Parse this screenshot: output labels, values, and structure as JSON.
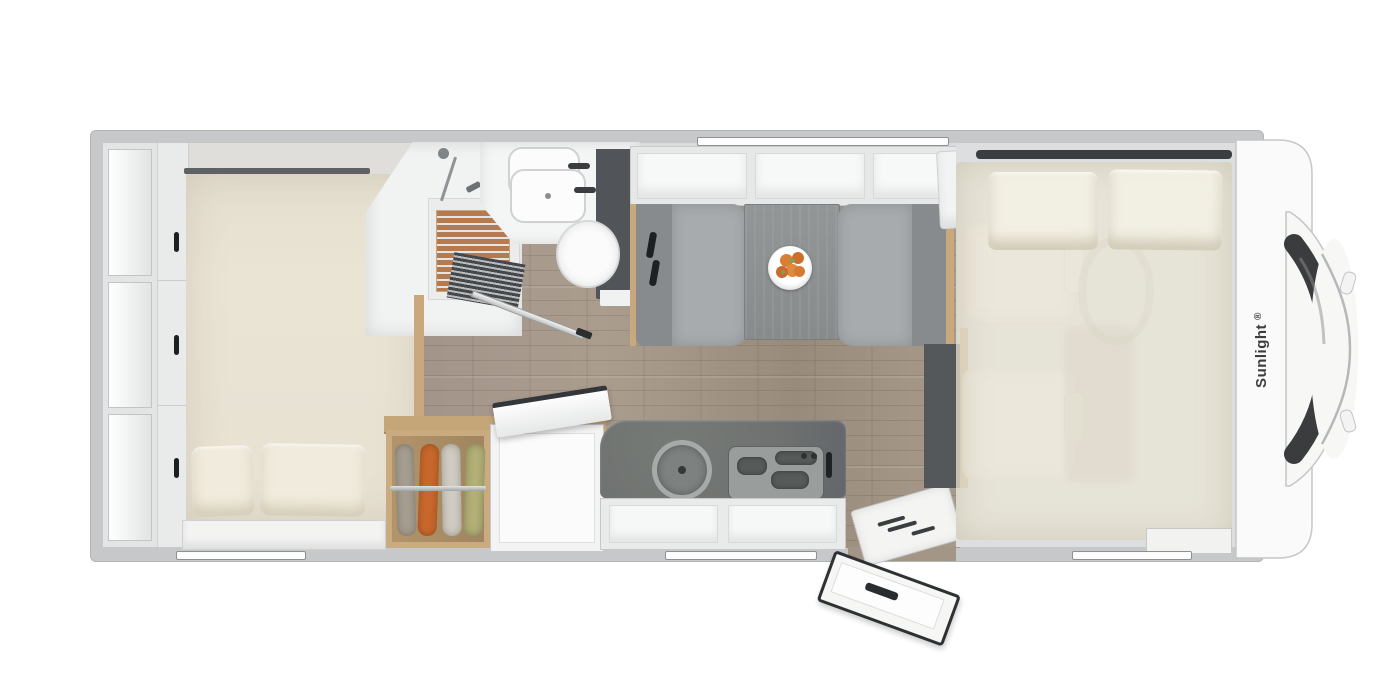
{
  "brand": {
    "label": "Sunlight",
    "registered": "®"
  },
  "colors": {
    "wall_gray": "#c6c8c9",
    "floor_wood": "#a49686",
    "mattress_beige": "#e8e2d3",
    "bench_fabric_gray": "#a7abad",
    "counter_dark": "#6e716f",
    "teak_shower": "#b57a50",
    "wood_trim": "#c8a87c",
    "dark_panel": "#54585a",
    "garments": [
      "#a59e90",
      "#c9682c",
      "#d0ccc3",
      "#b2b077"
    ],
    "fruit_orange": "#d97e35",
    "brand_text": "#3c3f41"
  }
}
